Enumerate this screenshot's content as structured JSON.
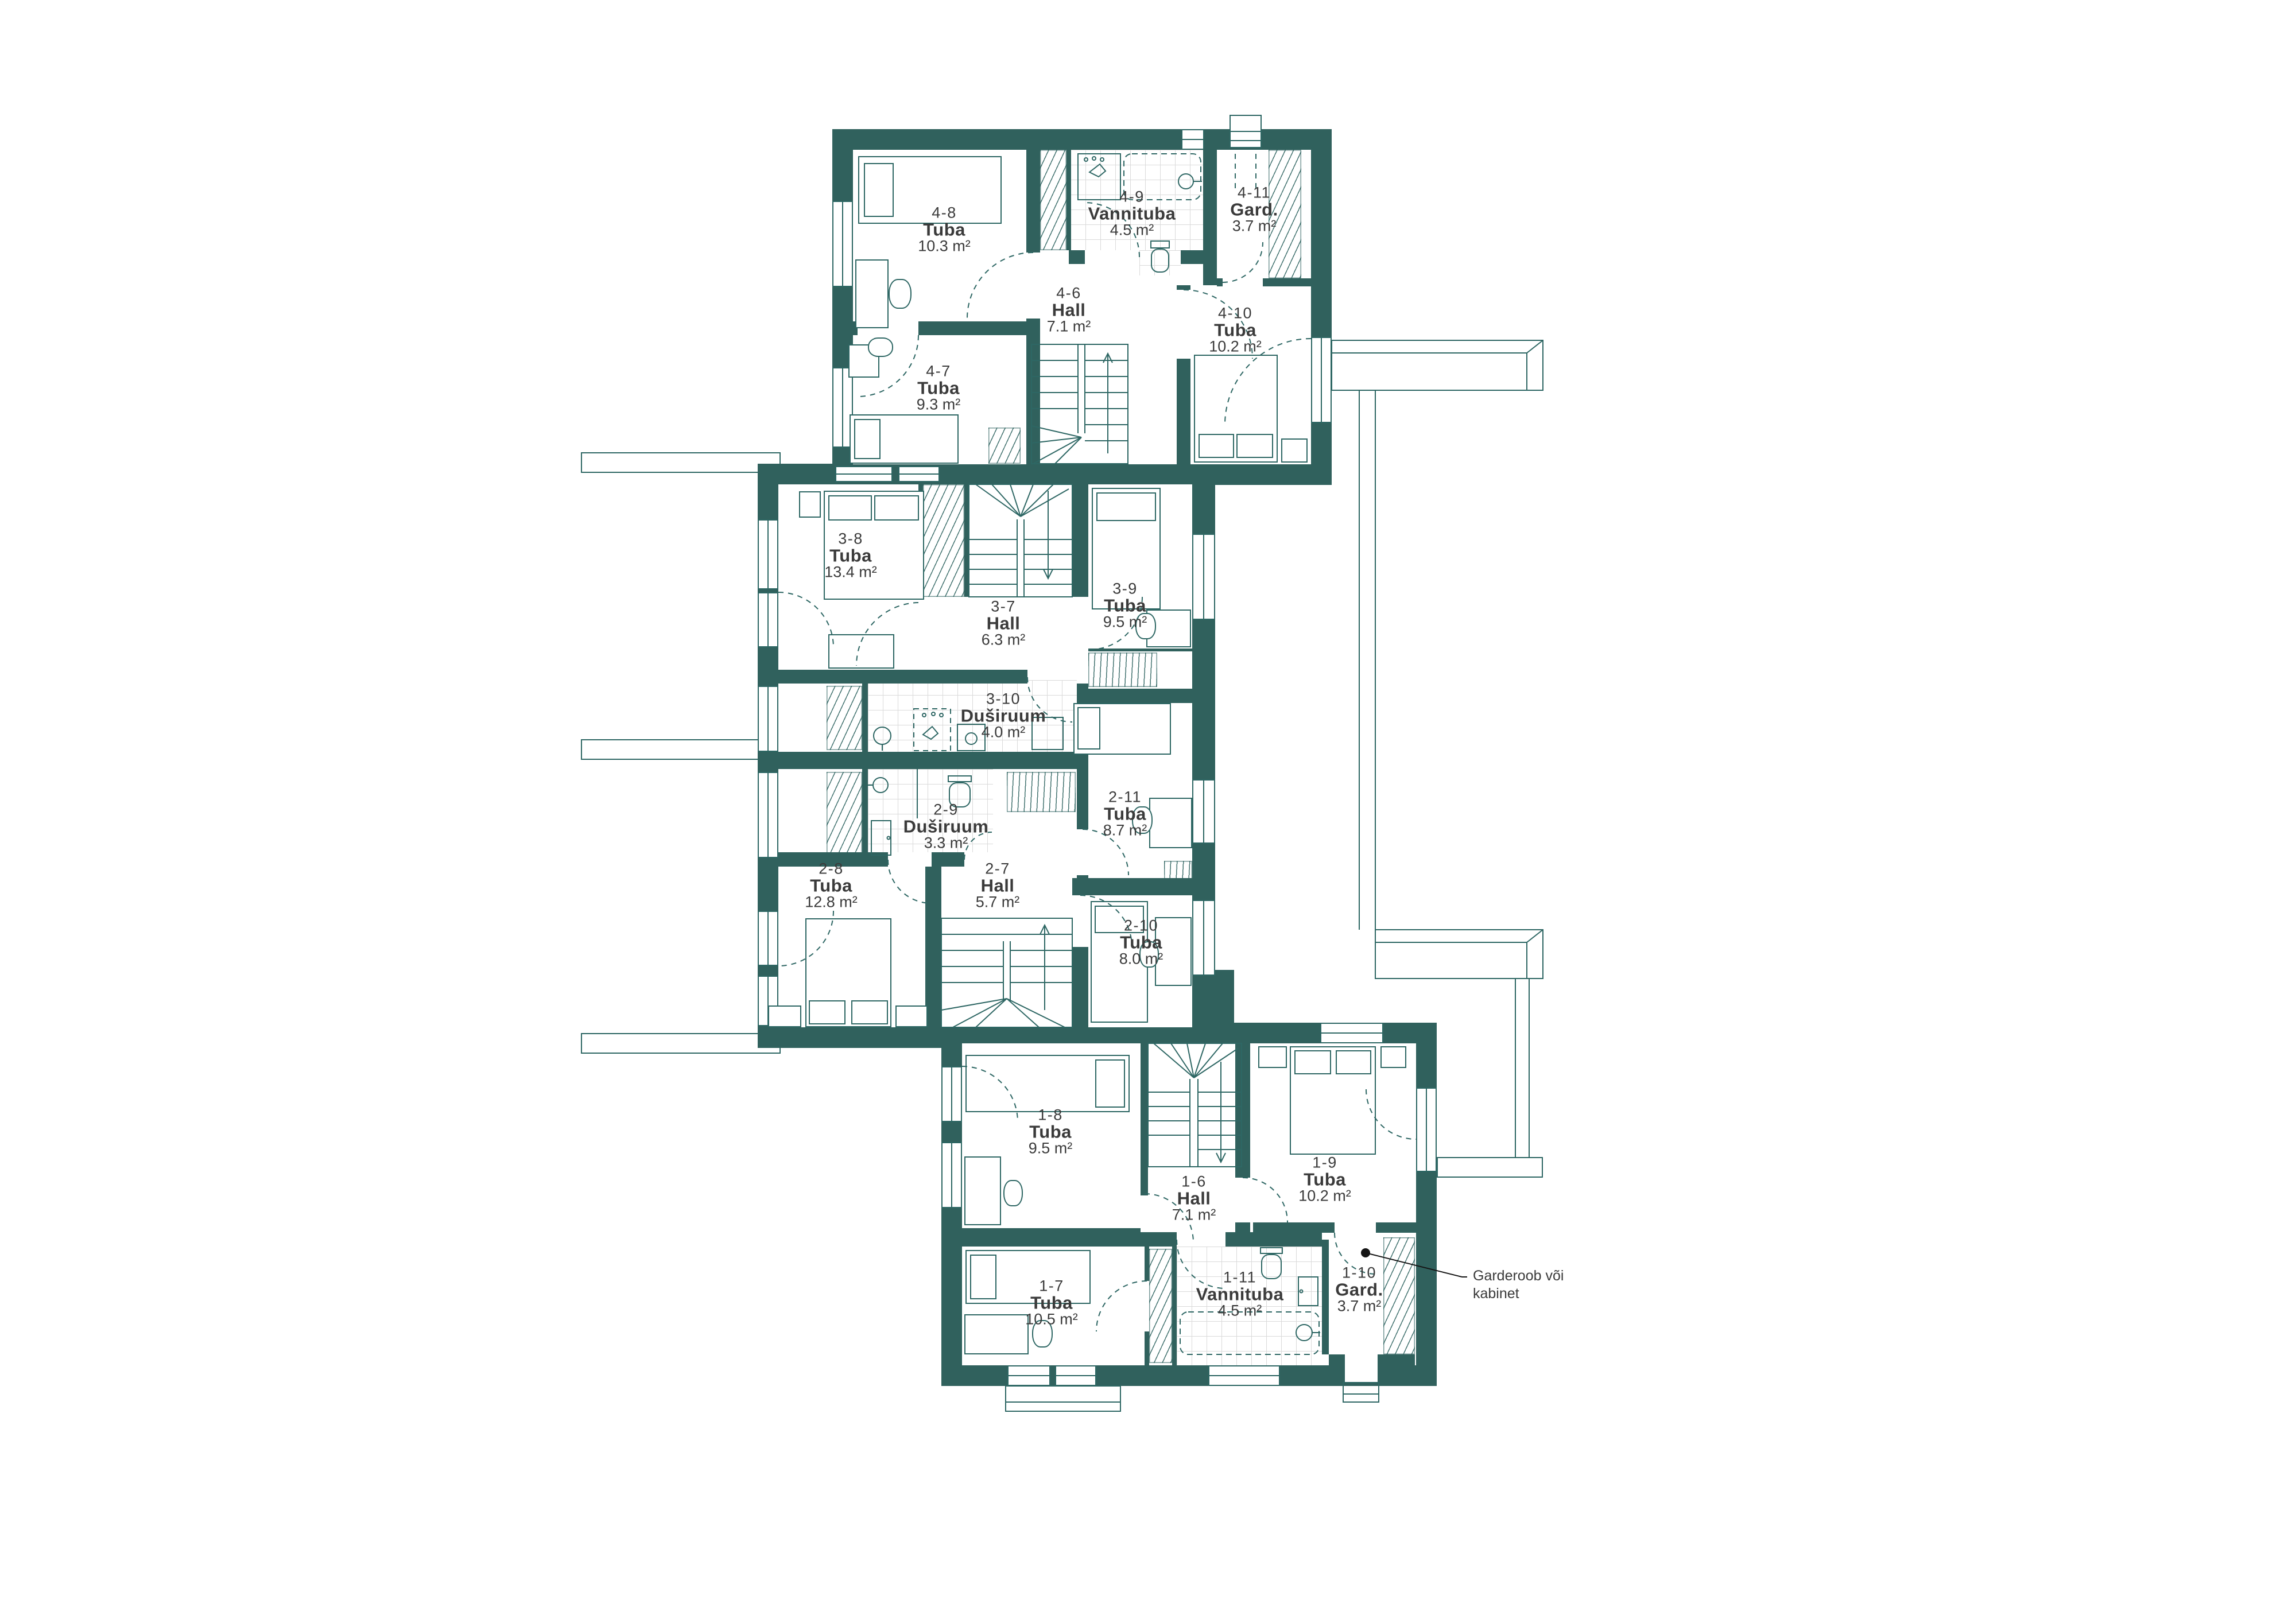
{
  "colors": {
    "wall": "#30615D",
    "linework": "#2E6764",
    "tile_grid": "#DADADA",
    "text": "#3B3B3B",
    "background": "#FFFFFF"
  },
  "rooms": [
    {
      "code": "4-6",
      "name": "Hall",
      "area": "7.1 m²"
    },
    {
      "code": "4-7",
      "name": "Tuba",
      "area": "9.3 m²"
    },
    {
      "code": "4-8",
      "name": "Tuba",
      "area": "10.3 m²"
    },
    {
      "code": "4-9",
      "name": "Vannituba",
      "area": "4.5 m²"
    },
    {
      "code": "4-10",
      "name": "Tuba",
      "area": "10.2 m²"
    },
    {
      "code": "4-11",
      "name": "Gard.",
      "area": "3.7 m²"
    },
    {
      "code": "3-7",
      "name": "Hall",
      "area": "6.3 m²"
    },
    {
      "code": "3-8",
      "name": "Tuba",
      "area": "13.4 m²"
    },
    {
      "code": "3-9",
      "name": "Tuba",
      "area": "9.5 m²"
    },
    {
      "code": "3-10",
      "name": "Duširuum",
      "area": "4.0 m²"
    },
    {
      "code": "2-7",
      "name": "Hall",
      "area": "5.7 m²"
    },
    {
      "code": "2-8",
      "name": "Tuba",
      "area": "12.8 m²"
    },
    {
      "code": "2-9",
      "name": "Duširuum",
      "area": "3.3 m²"
    },
    {
      "code": "2-10",
      "name": "Tuba",
      "area": "8.0 m²"
    },
    {
      "code": "2-11",
      "name": "Tuba",
      "area": "8.7 m²"
    },
    {
      "code": "1-6",
      "name": "Hall",
      "area": "7.1 m²"
    },
    {
      "code": "1-7",
      "name": "Tuba",
      "area": "10.5 m²"
    },
    {
      "code": "1-8",
      "name": "Tuba",
      "area": "9.5 m²"
    },
    {
      "code": "1-9",
      "name": "Tuba",
      "area": "10.2 m²"
    },
    {
      "code": "1-10",
      "name": "Gard.",
      "area": "3.7 m²"
    },
    {
      "code": "1-11",
      "name": "Vannituba",
      "area": "4.5 m²"
    }
  ],
  "annotation": {
    "line1": "Garderoob või",
    "line2": "kabinet"
  }
}
